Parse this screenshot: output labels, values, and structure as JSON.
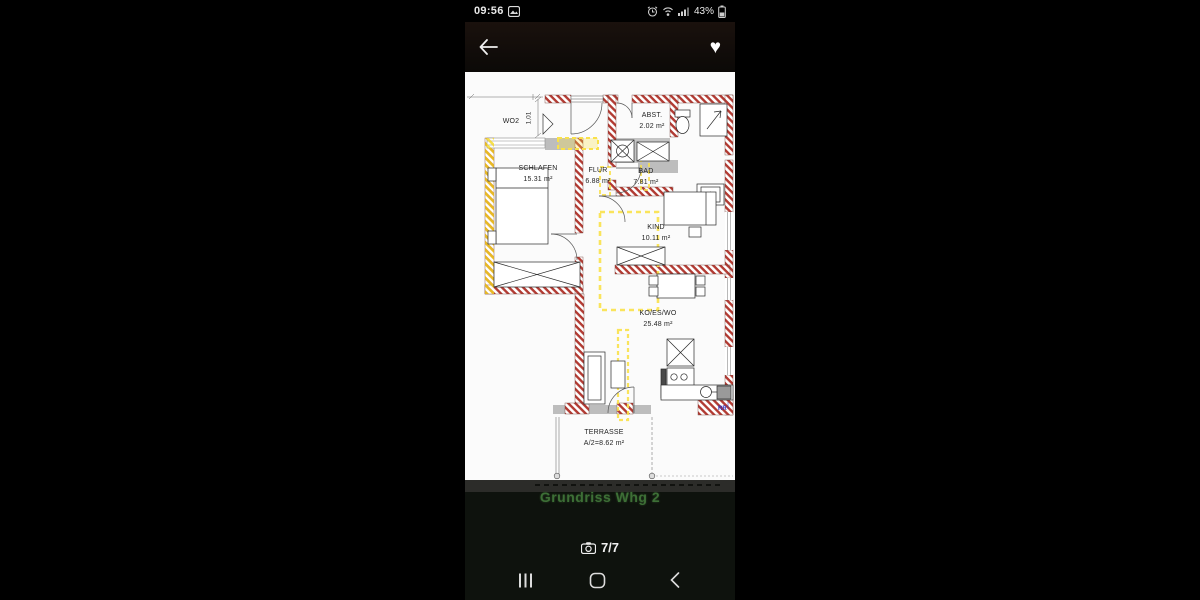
{
  "status_bar": {
    "time": "09:56",
    "battery_percent": "43%"
  },
  "gallery": {
    "caption": "Grundriss Whg 2",
    "counter": "7/7"
  },
  "plan": {
    "rooms": [
      {
        "name": "SCHLAFEN",
        "area": "15.31 m²"
      },
      {
        "name": "FLUR",
        "area": "6.88 m²"
      },
      {
        "name": "BAD",
        "area": "7.81 m²"
      },
      {
        "name": "ABST.",
        "area": "2.02 m²"
      },
      {
        "name": "KIND",
        "area": "10.11 m²"
      },
      {
        "name": "KO/ES/WO",
        "area": "25.48 m²"
      },
      {
        "name": "TERRASSE",
        "area": "A/2=8.62 m²"
      }
    ],
    "annotations": {
      "door_label": "WO2",
      "door_width": "1,01",
      "drainpipe": "RR"
    }
  },
  "colors": {
    "wall_hatch_red": "#b23a32",
    "highlight_yellow": "#f9e14a",
    "window_gray": "#bdbdbd",
    "caption_green": "#3d6f36"
  }
}
